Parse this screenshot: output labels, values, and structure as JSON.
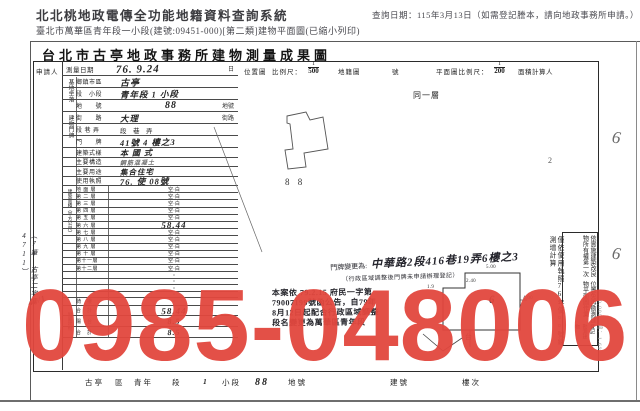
{
  "header": {
    "system_title": "北北桃地政電傳全功能地籍資料查詢系統",
    "query_date": "查詢日期：115年3月13日（如需登記謄本，請向地政事務所申請。）",
    "subtitle": "臺北市萬華區青年段一小段(建號:09451-000)[第二類]建物平面圖(已縮小列印)"
  },
  "doc": {
    "title": "台北市古亭地政事務所建物測量成果圖",
    "applicant_label": "申請人",
    "survey": {
      "label": "測量日期",
      "value": "76. 9.24",
      "suffix": "日"
    },
    "scales": {
      "location_label": "位置圖",
      "ratio_label": "比例尺：",
      "loc_num": "1",
      "loc_den": "500",
      "cadastral_label": "地籍圖",
      "sheet_label": "號",
      "plan_label": "平面圖比例尺：",
      "plan_num": "1",
      "plan_den": "200",
      "calculator_label": "面積計算人"
    },
    "site_group_label": "基地坐落",
    "door_group_label": "建物門牌",
    "area_group_label": "建築面積（平方公尺）",
    "annex_group_label": "附屬建物",
    "upper_rows": [
      {
        "label": "鄉鎮市區",
        "value": "古亭",
        "suffix": ""
      },
      {
        "label": "段　小段",
        "value": "青年段 1 小段",
        "suffix": ""
      },
      {
        "label": "地　　號",
        "value": "88",
        "suffix": "地號"
      },
      {
        "label": "街　　路",
        "value": "大理",
        "suffix": "街路"
      },
      {
        "label": "段 巷 弄",
        "value": "段　巷　弄",
        "suffix": ""
      },
      {
        "label": "門　　牌",
        "value": "41號 4 樓之3",
        "suffix": ""
      },
      {
        "label": "建築式樣",
        "value": "本 國 式",
        "suffix": ""
      },
      {
        "label": "主要構造",
        "value": "鋼筋混凝土",
        "suffix": ""
      },
      {
        "label": "主要用途",
        "value": "集合住宅",
        "suffix": ""
      },
      {
        "label": "使用執照",
        "value": "76. 使 08號",
        "suffix": ""
      }
    ],
    "floors": [
      {
        "label": "地 面 層",
        "value": "空·白"
      },
      {
        "label": "第 二 層",
        "value": "空·白"
      },
      {
        "label": "第 三 層",
        "value": "空·白"
      },
      {
        "label": "第 四 層",
        "value": "空·白"
      },
      {
        "label": "第 五 層",
        "value": "空·白"
      },
      {
        "label": "第 六 層",
        "value": "58.44"
      },
      {
        "label": "第 七 層",
        "value": "空·白"
      },
      {
        "label": "第 八 層",
        "value": "空·白"
      },
      {
        "label": "第 九 層",
        "value": "空·白"
      },
      {
        "label": "第 十 層",
        "value": "空·白"
      },
      {
        "label": "第十一層",
        "value": "空·白"
      },
      {
        "label": "第十二層",
        "value": "空·白"
      },
      {
        "label": "",
        "value": "・"
      },
      {
        "label": "",
        "value": "・"
      },
      {
        "label": "",
        "value": "・"
      },
      {
        "label": "",
        "value": "・"
      },
      {
        "label": "騎　樓",
        "value": "・"
      },
      {
        "label": "合　計",
        "value": "58.44"
      },
      {
        "label": "陽　台",
        "value": "8.5"
      },
      {
        "label": "合　計",
        "value": "8.5"
      }
    ],
    "left_margin_note": "（7筆 古亭二字第4711）",
    "left_margin_mark": "47/1",
    "annotations": {
      "door_change_prefix": "門牌變更為:",
      "door_change_value": "中華路2段416巷19弄6樓之3",
      "door_change_note": "（行政區域調整後門牌未申請辦理登記）",
      "same_floor": "同一層",
      "parcel_label": "8 8",
      "plan_number": "6",
      "plan_sub": "台",
      "dim1": "5.00",
      "dim2": "2.40",
      "dim3": "1.9",
      "dim4": "4.00",
      "margin_mark_top": "6",
      "margin_mark_bottom": "6",
      "stray_mark": "2",
      "print_info": "0,000　縮：1.69"
    },
    "stamp_lines": [
      "本案依 79.2.15 府民一字第",
      "79007199號函公告，自79年",
      "8月12日起配合行政區域調整",
      "段名變更為萬華區青年段"
    ],
    "right_notes": {
      "outer_col": "僅依使用執照76年使○○號繪測增計算",
      "box_col1": "依實施建築改良物所有權第一次",
      "box_col2": "位置免再勘測建物平面圖作業",
      "box_col3": "登記　勘測建物"
    },
    "bottom_strip": {
      "district": "古亭",
      "district_label": "區",
      "section": "青年",
      "section_label": "段",
      "subsection": "1",
      "subsection_label": "小段",
      "parcel": "88",
      "parcel_label": "地號",
      "building_label": "建號",
      "floor_label": "樓次"
    }
  },
  "watermark": {
    "text": "0985-048006",
    "color": "#e2473e"
  }
}
